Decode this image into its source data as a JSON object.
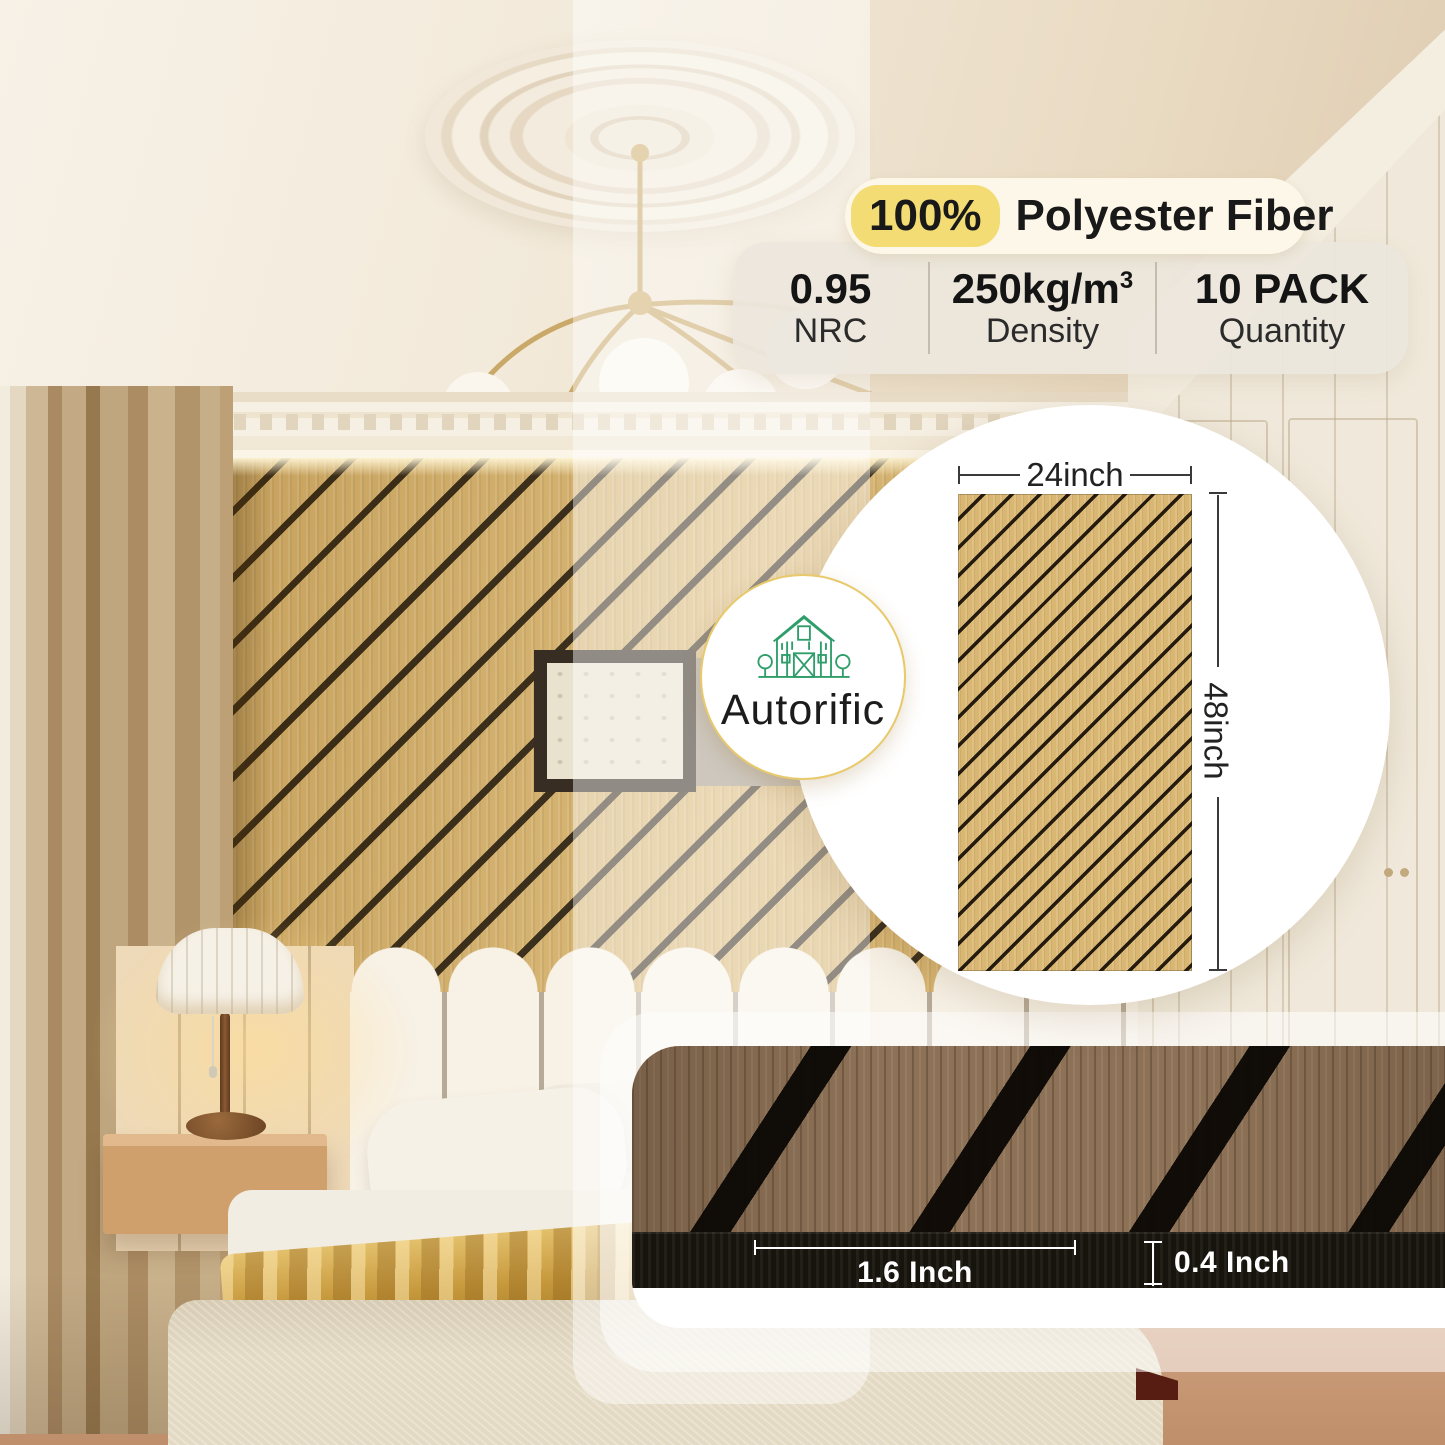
{
  "brand": {
    "name": "Autorific"
  },
  "product_badge": {
    "highlight": "100%",
    "title": "Polyester Fiber",
    "stats": [
      {
        "value": "0.95",
        "sup": "",
        "label": "NRC"
      },
      {
        "value": "250kg/m",
        "sup": "3",
        "label": "Density"
      },
      {
        "value": "10 PACK",
        "sup": "",
        "label": "Quantity"
      }
    ]
  },
  "panel_diagram": {
    "width_label": "24inch",
    "height_label": "48inch"
  },
  "slat_closeup": {
    "slat_width_label": "1.6 Inch",
    "thickness_label": "0.4 Inch"
  },
  "colors": {
    "highlight_yellow": "#f3dc74",
    "brand_green": "#2f9e6a",
    "logo_ring_gold": "#e8c96c",
    "oak_wood": "#d8b46e",
    "walnut_wood": "#8d7257",
    "felt_black": "#17130d"
  }
}
